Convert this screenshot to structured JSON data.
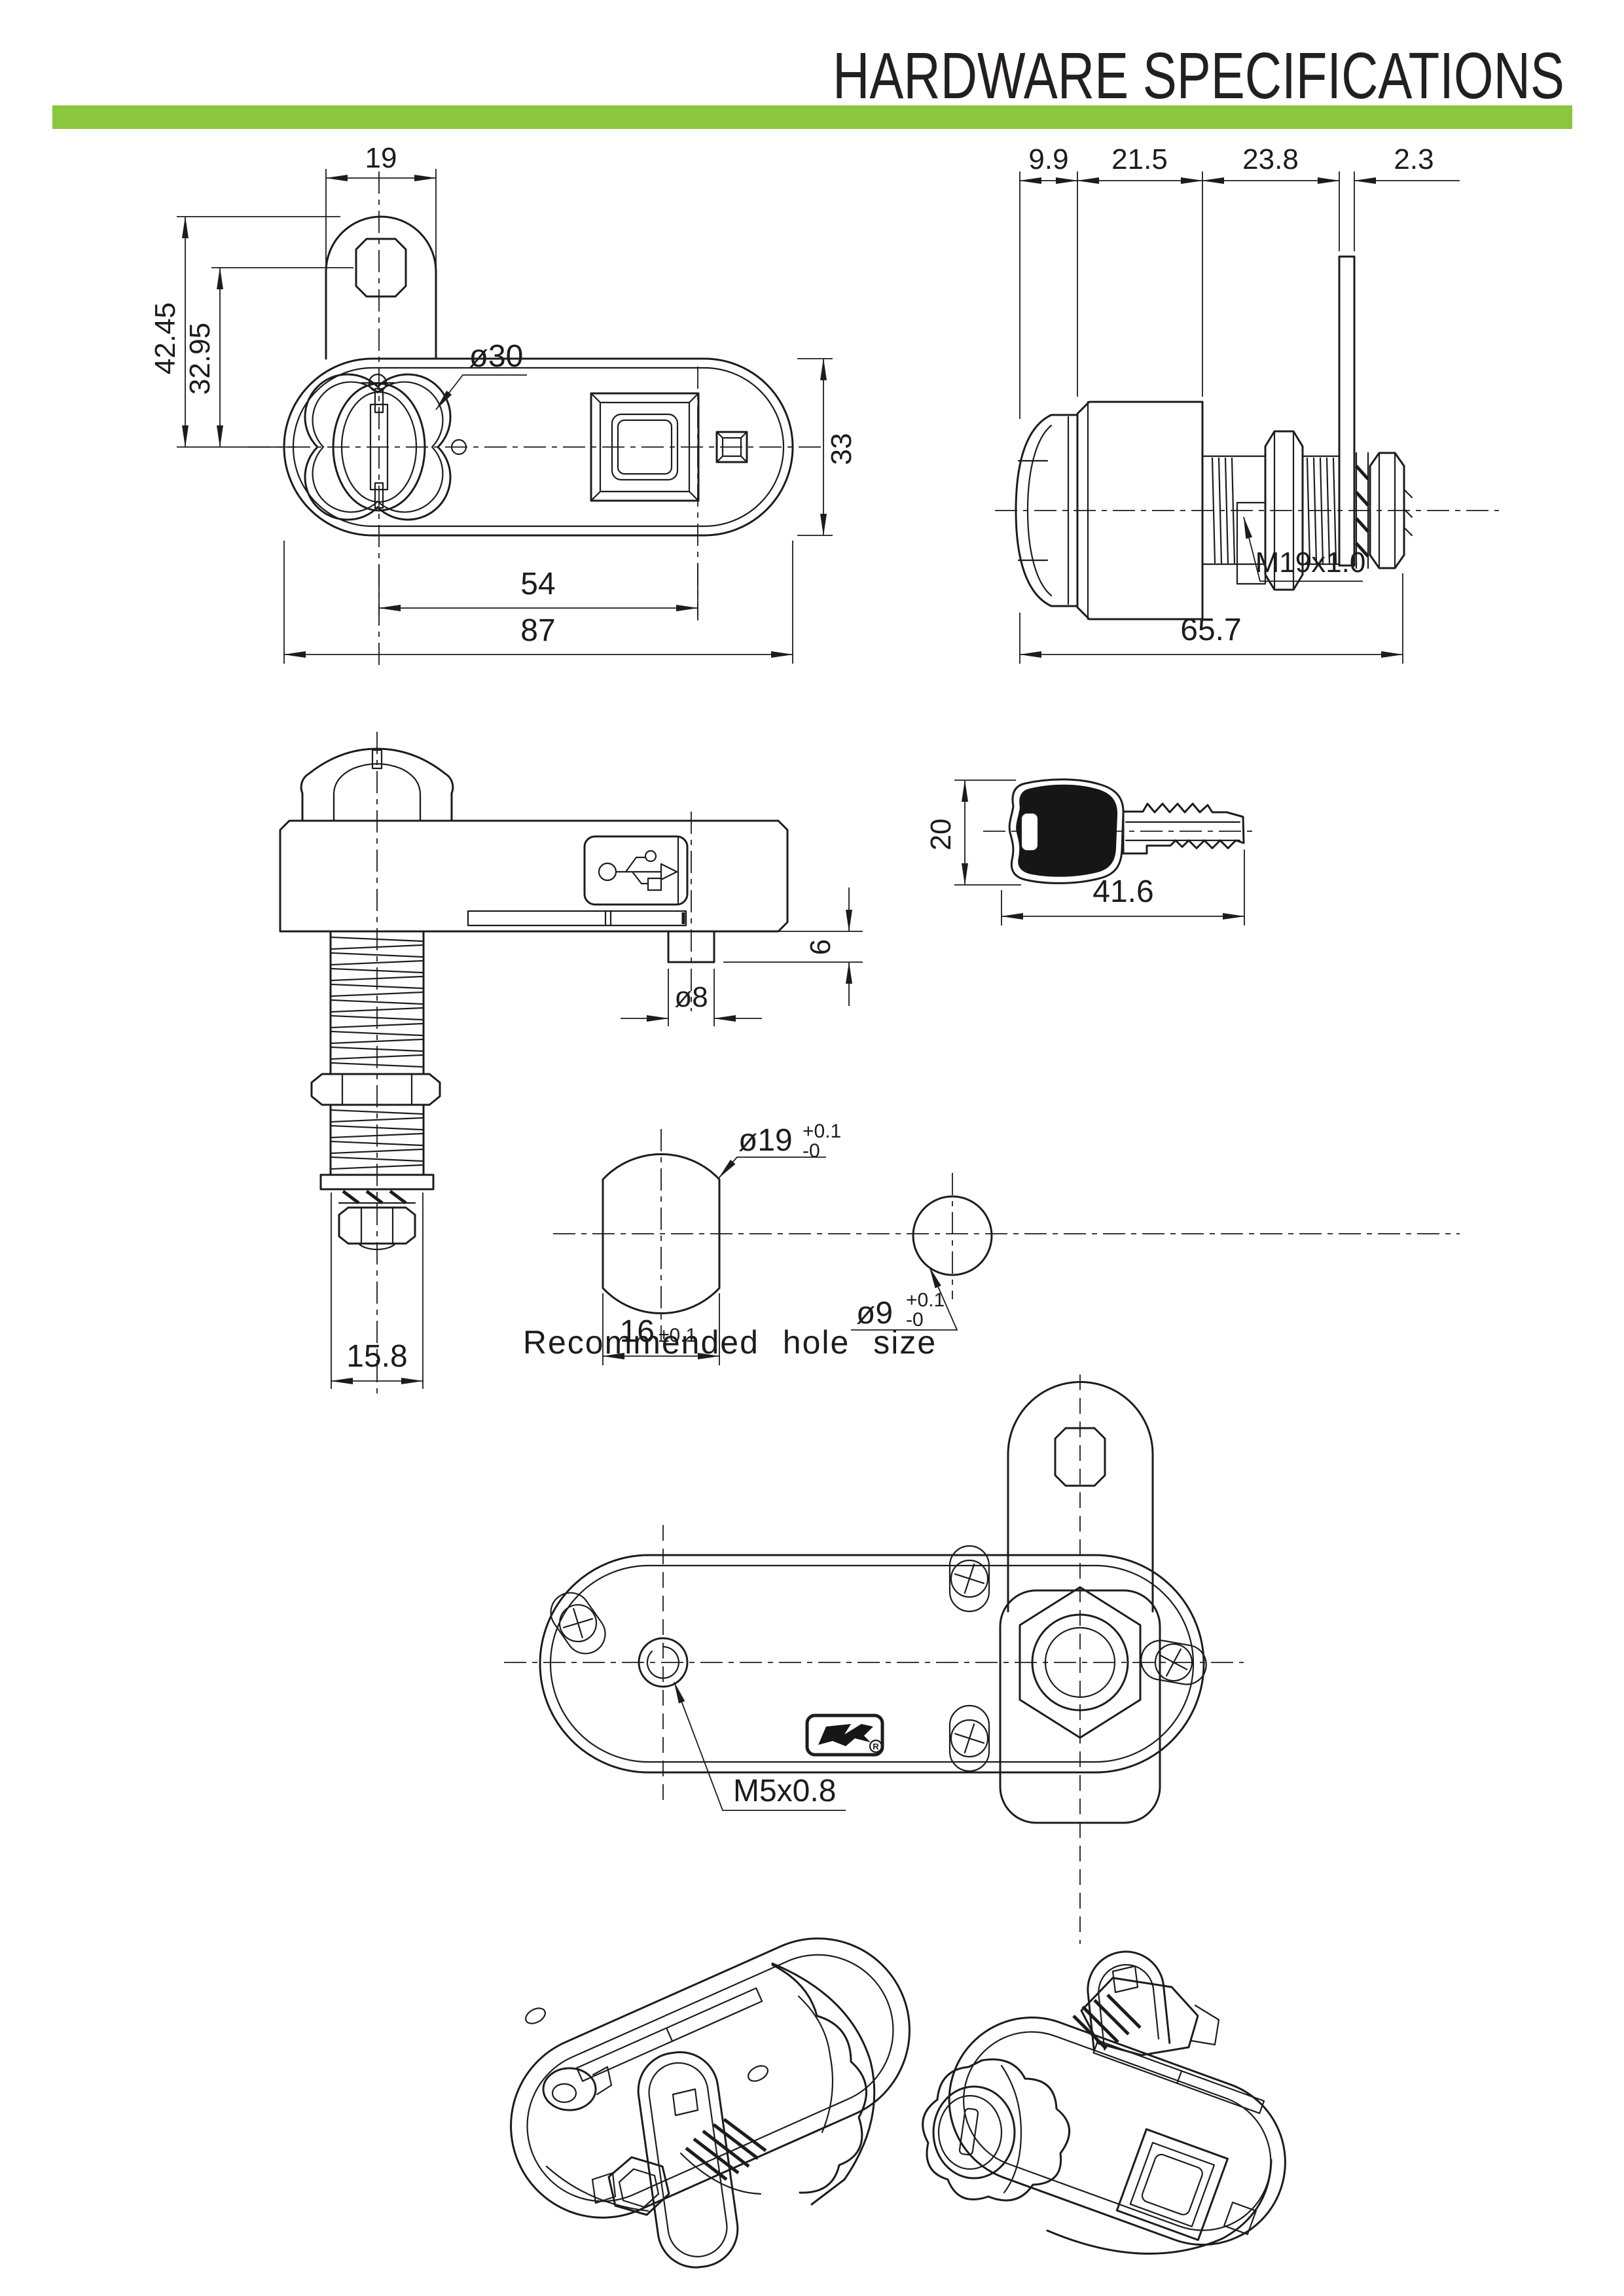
{
  "title": "HARDWARE SPECIFICATIONS",
  "colors": {
    "accent_green": "#8CC63E",
    "line": "#1c1c1c"
  },
  "views": {
    "front": {
      "label": "front-view-of-cam-lock",
      "dims": {
        "cam_width": "19",
        "total_height": "42.45",
        "hole_height": "32.95",
        "rosette_dia": "ø30",
        "body_height": "33",
        "key_to_square": "54",
        "body_width": "87"
      }
    },
    "side": {
      "label": "side-view-of-cam-lock",
      "dims": {
        "knob_depth": "9.9",
        "body_depth": "21.5",
        "thread_length": "23.8",
        "cam_thickness": "2.3",
        "thread_spec": "M19x1.0",
        "total_length": "65.7"
      }
    },
    "bottom": {
      "label": "bottom-view-of-cam-lock",
      "dims": {
        "nut_width": "15.8",
        "tab_dia": "ø8",
        "tab_height": "6"
      }
    },
    "key": {
      "label": "key-profile",
      "dims": {
        "head_height": "20",
        "total_length": "41.6"
      }
    },
    "holes": {
      "caption": "Recommended hole size",
      "dims": {
        "main_dia": "ø19",
        "main_tol_plus": "+0.1",
        "main_tol_minus": "-0",
        "flat_width": "16",
        "flat_tol": "±0.1",
        "small_dia": "ø9",
        "small_tol_plus": "+0.1",
        "small_tol_minus": "-0"
      }
    },
    "back": {
      "label": "back-view-of-cam-lock",
      "dims": {
        "screw_spec": "M5x0.8"
      },
      "logo_mark": "R"
    }
  }
}
